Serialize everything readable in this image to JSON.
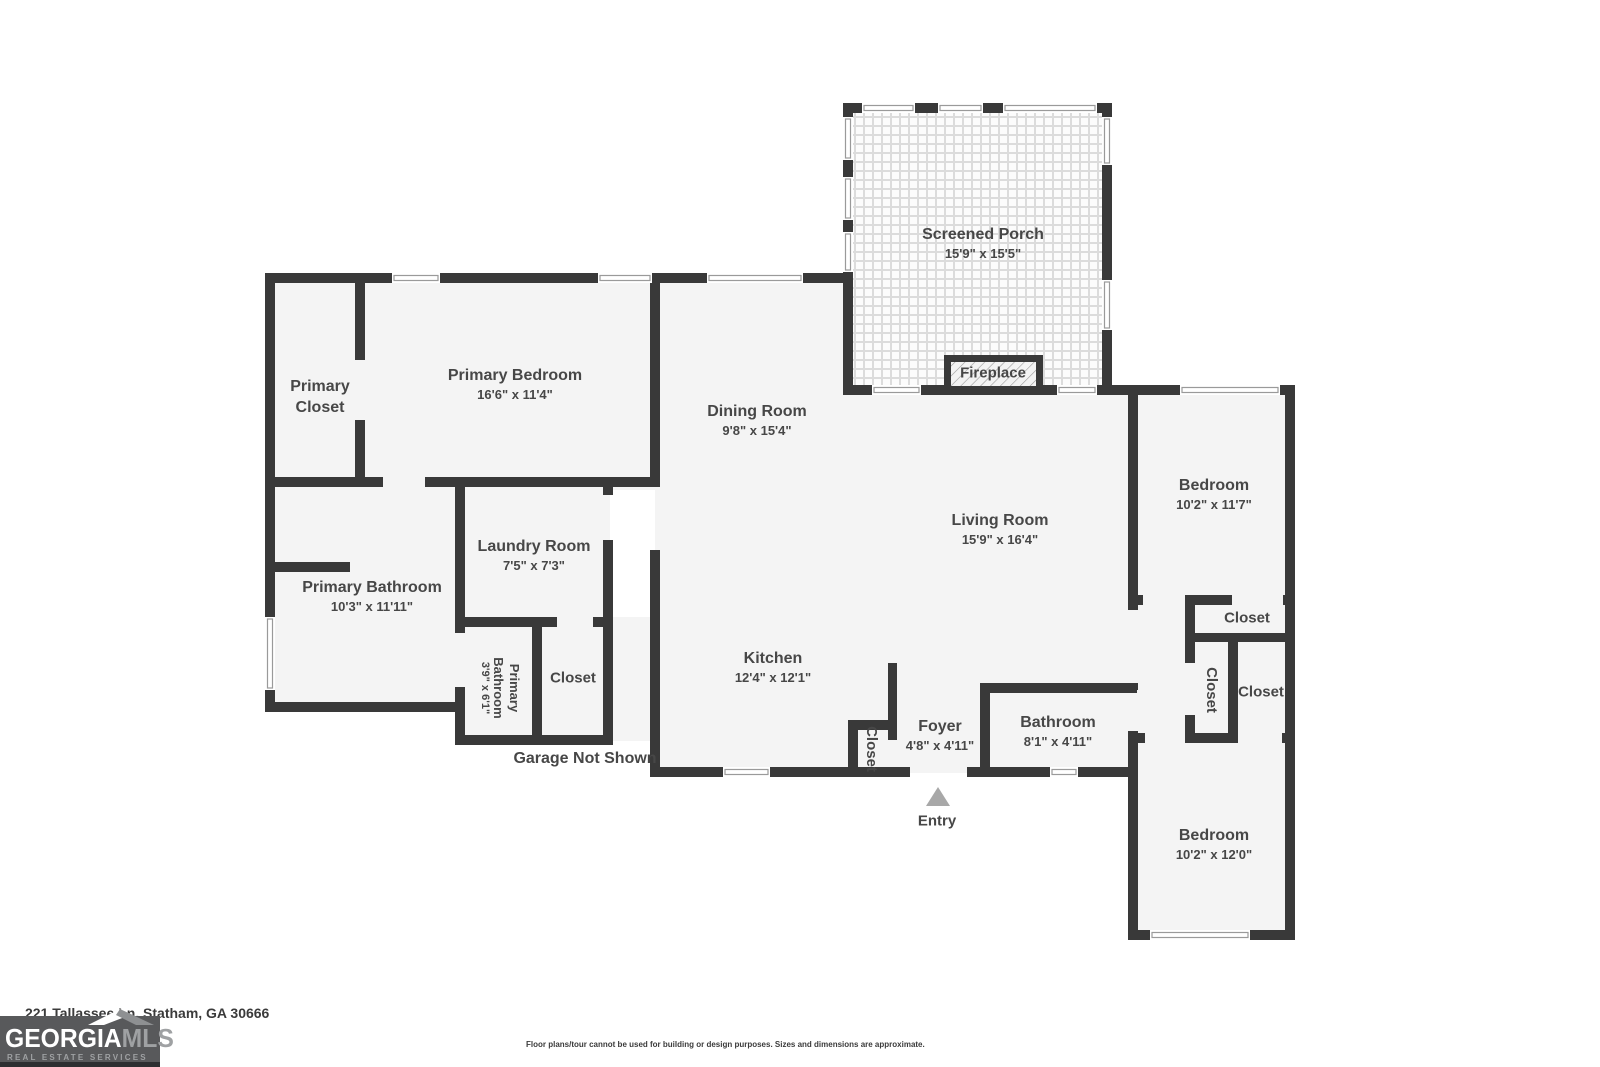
{
  "colors": {
    "wall": "#393939",
    "floor": "#f4f4f4",
    "label": "#474747",
    "entry_arrow": "#a8a8a8",
    "logo_bg": "#58595b"
  },
  "rooms": {
    "screened_porch": {
      "name": "Screened Porch",
      "dims": "15'9\" x 15'5\""
    },
    "primary_closet": {
      "name": "Primary Closet",
      "dims": ""
    },
    "primary_bedroom": {
      "name": "Primary Bedroom",
      "dims": "16'6\" x 11'4\""
    },
    "dining_room": {
      "name": "Dining Room",
      "dims": "9'8\" x 15'4\""
    },
    "living_room": {
      "name": "Living Room",
      "dims": "15'9\" x 16'4\""
    },
    "bedroom_upper": {
      "name": "Bedroom",
      "dims": "10'2\" x 11'7\""
    },
    "laundry_room": {
      "name": "Laundry Room",
      "dims": "7'5\" x 7'3\""
    },
    "primary_bathroom": {
      "name": "Primary Bathroom",
      "dims": "10'3\" x 11'11\""
    },
    "primary_bathroom_wc": {
      "name": "Primary Bathroom",
      "dims": "3'9\" x 6'1\""
    },
    "closet_by_laundry": {
      "name": "Closet",
      "dims": ""
    },
    "kitchen": {
      "name": "Kitchen",
      "dims": "12'4\" x 12'1\""
    },
    "closet_foyer": {
      "name": "Closet",
      "dims": ""
    },
    "foyer": {
      "name": "Foyer",
      "dims": "4'8\" x 4'11\""
    },
    "bathroom": {
      "name": "Bathroom",
      "dims": "8'1\" x 4'11\""
    },
    "closet_top_right": {
      "name": "Closet",
      "dims": ""
    },
    "closet_mid_vertical": {
      "name": "Closet",
      "dims": ""
    },
    "closet_mid_right": {
      "name": "Closet",
      "dims": ""
    },
    "bedroom_lower": {
      "name": "Bedroom",
      "dims": "10'2\" x 12'0\""
    }
  },
  "annotations": {
    "fireplace": "Fireplace",
    "entry": "Entry",
    "garage_note": "Garage Not Shown"
  },
  "footer": {
    "address": "221 Tallassee Ln, Statham, GA 30666",
    "disclaimer": "Floor plans/tour cannot be used for building or design purposes. Sizes and dimensions are approximate."
  },
  "logo": {
    "brand_primary": "GEORGIA",
    "brand_secondary": "MLS",
    "tagline": "REAL ESTATE SERVICES"
  }
}
